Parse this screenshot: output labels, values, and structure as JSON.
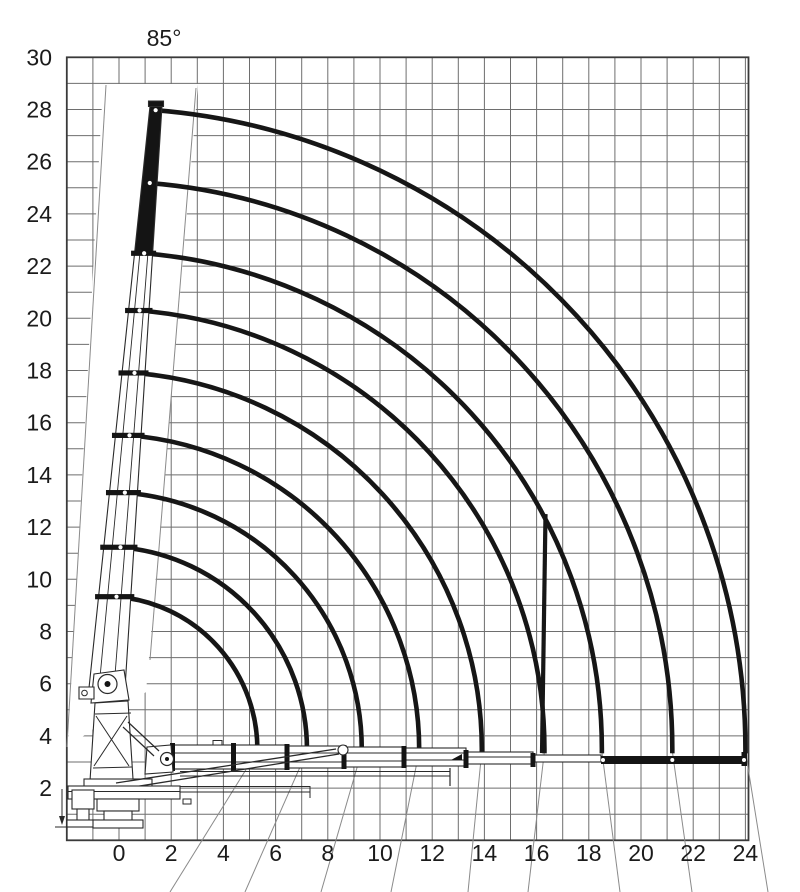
{
  "page": {
    "background": "#ffffff"
  },
  "chart_data": {
    "type": "line",
    "subtype": "crane-working-range-envelopes",
    "angle_label": "85°",
    "x_axis": {
      "ticks": [
        0,
        2,
        4,
        6,
        8,
        10,
        12,
        14,
        16,
        18,
        20,
        22,
        24
      ],
      "range": [
        -2,
        24.1
      ],
      "grid_step": 1
    },
    "y_axis": {
      "ticks": [
        2,
        4,
        6,
        8,
        10,
        12,
        14,
        16,
        18,
        20,
        22,
        24,
        26,
        28,
        30
      ],
      "range": [
        0,
        30
      ],
      "grid_step": 1
    },
    "grid": true,
    "max_boom_angle_deg": 85,
    "boom_pivot": {
      "x_m": -0.57,
      "y_m": 3.5
    },
    "ground_line_height_m": 3.3,
    "envelopes": [
      {
        "reach_m": 5.3,
        "max_height_m": 9.3
      },
      {
        "reach_m": 7.2,
        "max_height_m": 11.2
      },
      {
        "reach_m": 9.3,
        "max_height_m": 13.4
      },
      {
        "reach_m": 11.5,
        "max_height_m": 15.5
      },
      {
        "reach_m": 13.9,
        "max_height_m": 17.9
      },
      {
        "reach_m": 16.3,
        "max_height_m": 20.3
      },
      {
        "reach_m": 18.5,
        "max_height_m": 22.6
      },
      {
        "reach_m": 21.2,
        "max_height_m": 25.2
      },
      {
        "reach_m": 24.0,
        "max_height_m": 28.0
      }
    ],
    "vertical_boundary": {
      "x_m": 16.3,
      "from_height_m": 12.5,
      "to_height_m": 3.4
    }
  },
  "colors": {
    "arc": "#161616",
    "grid": "#6e6e6e",
    "border": "#3a3a3a",
    "text": "#1b1b1b",
    "thin_line": "#8a8a8a",
    "drawing": "#2a2a2a"
  }
}
